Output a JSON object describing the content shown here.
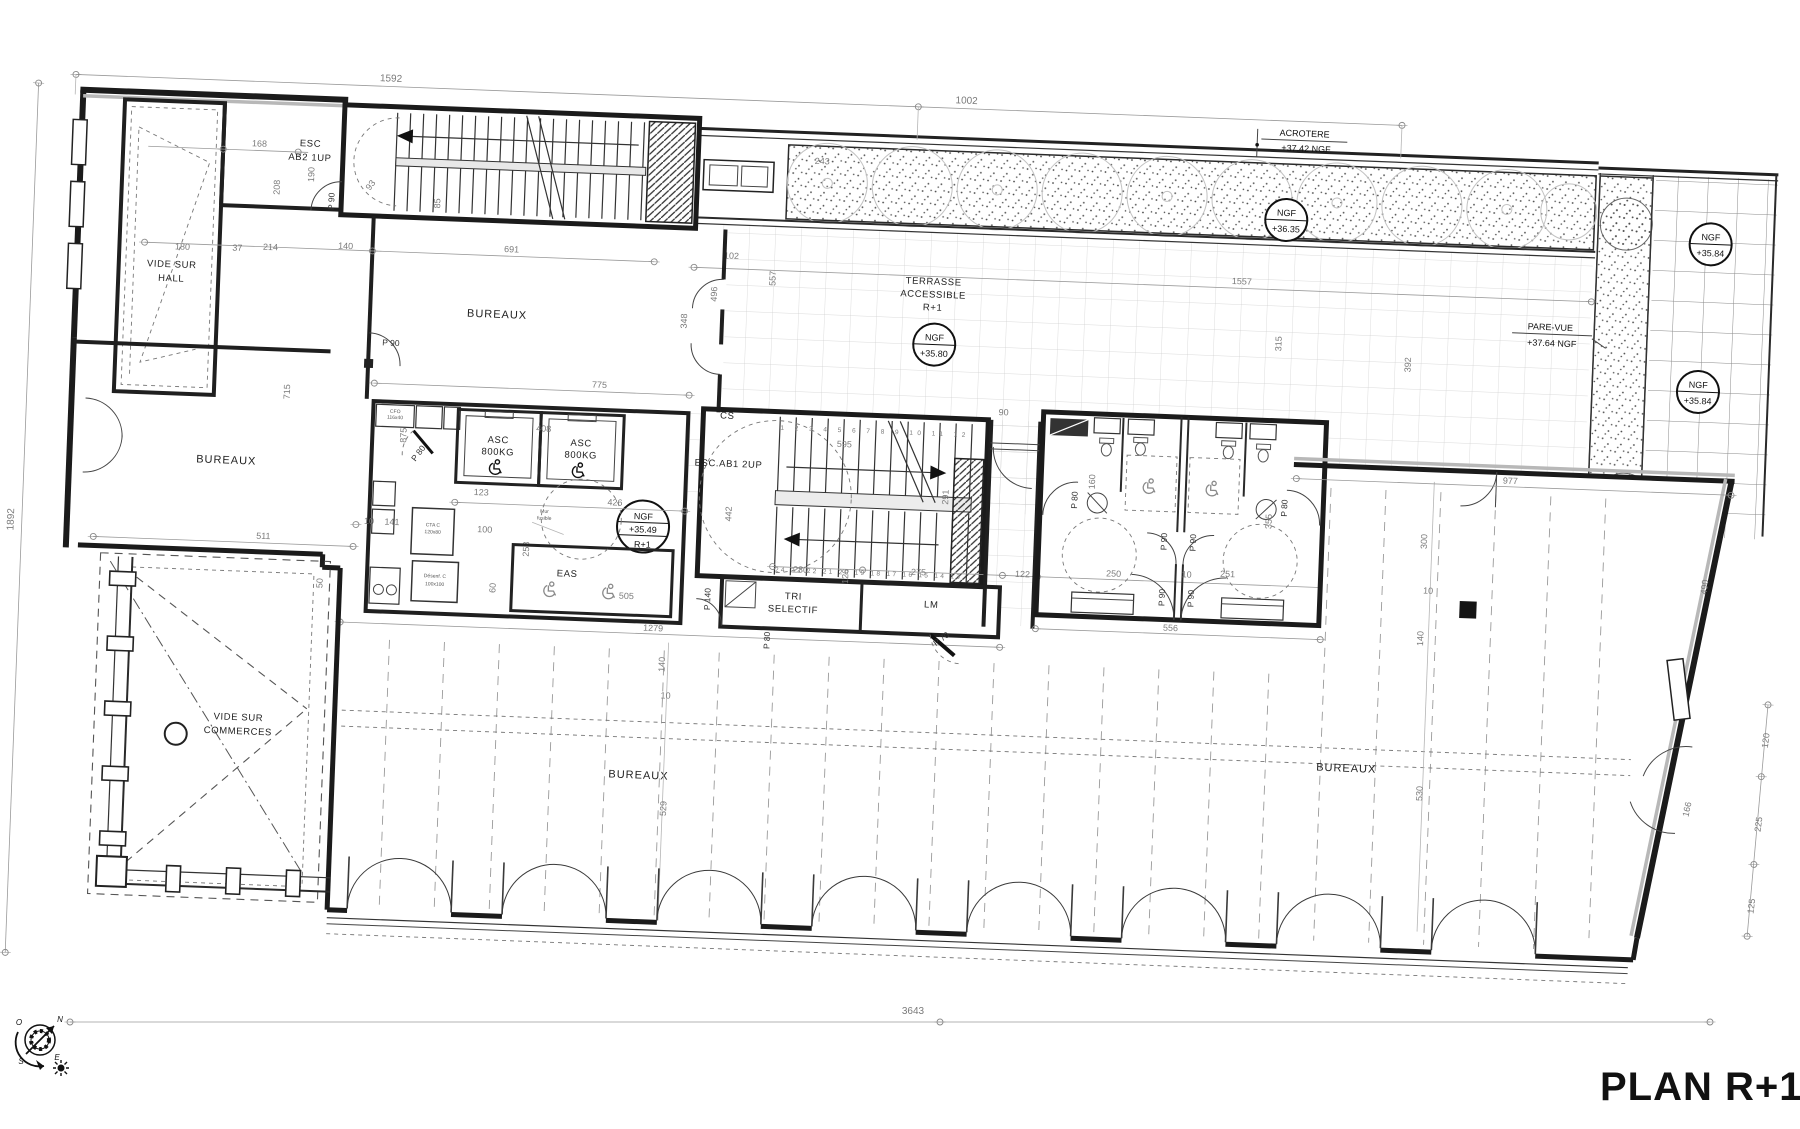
{
  "title": "PLAN R+1",
  "rooms": {
    "vide_hall_l1": "VIDE SUR",
    "vide_hall_l2": "HALL",
    "bureaux": "BUREAUX",
    "terrasse_l1": "TERRASSE",
    "terrasse_l2": "ACCESSIBLE",
    "terrasse_l3": "R+1",
    "eas": "EAS",
    "tri_l1": "TRI",
    "tri_l2": "SELECTIF",
    "lm": "LM",
    "vide_com_l1": "VIDE SUR",
    "vide_com_l2": "COMMERCES"
  },
  "stairs": {
    "ab2_l1": "ESC",
    "ab2_l2": "AB2 1UP",
    "ab1": "ESC.AB1 2UP",
    "cs": "CS",
    "top_run": "1 2 3 4 5 6 7 8 9 10 11 12",
    "bottom_run": "24 23 22 21 20 19 18 17 16 15 14 13"
  },
  "elevator": {
    "l1": "ASC",
    "l2": "800KG"
  },
  "levels": {
    "ngf": "NGF",
    "acro1": "ACROTERE",
    "acro2": "+37.42 NGF",
    "pv1": "PARE-VUE",
    "pv2": "+37.64 NGF",
    "n3635": "+36.35",
    "n3580": "+35.80",
    "n3549": "+35.49",
    "n3584": "+35.84",
    "r1": "R+1"
  },
  "doors": {
    "p90": "P 90",
    "p80": "P 80",
    "p70": "P 70",
    "p140": "P 140"
  },
  "equipment": {
    "cfo_l1": "CFO",
    "cfo_l2": "116x40",
    "cta_l1": "CTA C",
    "cta_l2": "120x80",
    "des_l1": "Désenf. C",
    "des_l2": "100x100",
    "mur_l1": "Mur",
    "mur_l2": "fusible"
  },
  "compass": {
    "n": "N",
    "s": "S",
    "e": "E",
    "o": "O"
  },
  "dims": {
    "v1592": "1592",
    "v1002": "1002",
    "v1892": "1892",
    "v3643": "3643",
    "v168": "168",
    "v208": "208",
    "v190": "190",
    "v180": "180",
    "v37": "37",
    "v214": "214",
    "v140": "140",
    "v691": "691",
    "v93": "93",
    "v85": "85",
    "v102": "102",
    "v557": "557",
    "v496": "496",
    "v348": "348",
    "v243": "243",
    "v1557": "1557",
    "v315": "315",
    "v392": "392",
    "v775": "775",
    "v875": "875",
    "v408": "408",
    "v426": "426",
    "v123": "123",
    "v100": "100",
    "v10": "10",
    "v141": "141",
    "v715": "715",
    "v511": "511",
    "v595": "595",
    "v291": "291",
    "v442": "442",
    "v230": "230",
    "v126": "126",
    "v275": "275",
    "v122": "122",
    "v250": "250",
    "v251": "251",
    "v355": "355",
    "v556": "556",
    "v300": "300",
    "v530": "530",
    "v490": "490",
    "v977": "977",
    "v120": "120",
    "v225": "225",
    "v125": "125",
    "v166": "166",
    "v1279": "1279",
    "v529": "529",
    "v60": "60",
    "v505": "505",
    "v258": "258",
    "v90": "90",
    "v160": "160",
    "v50": "50"
  }
}
